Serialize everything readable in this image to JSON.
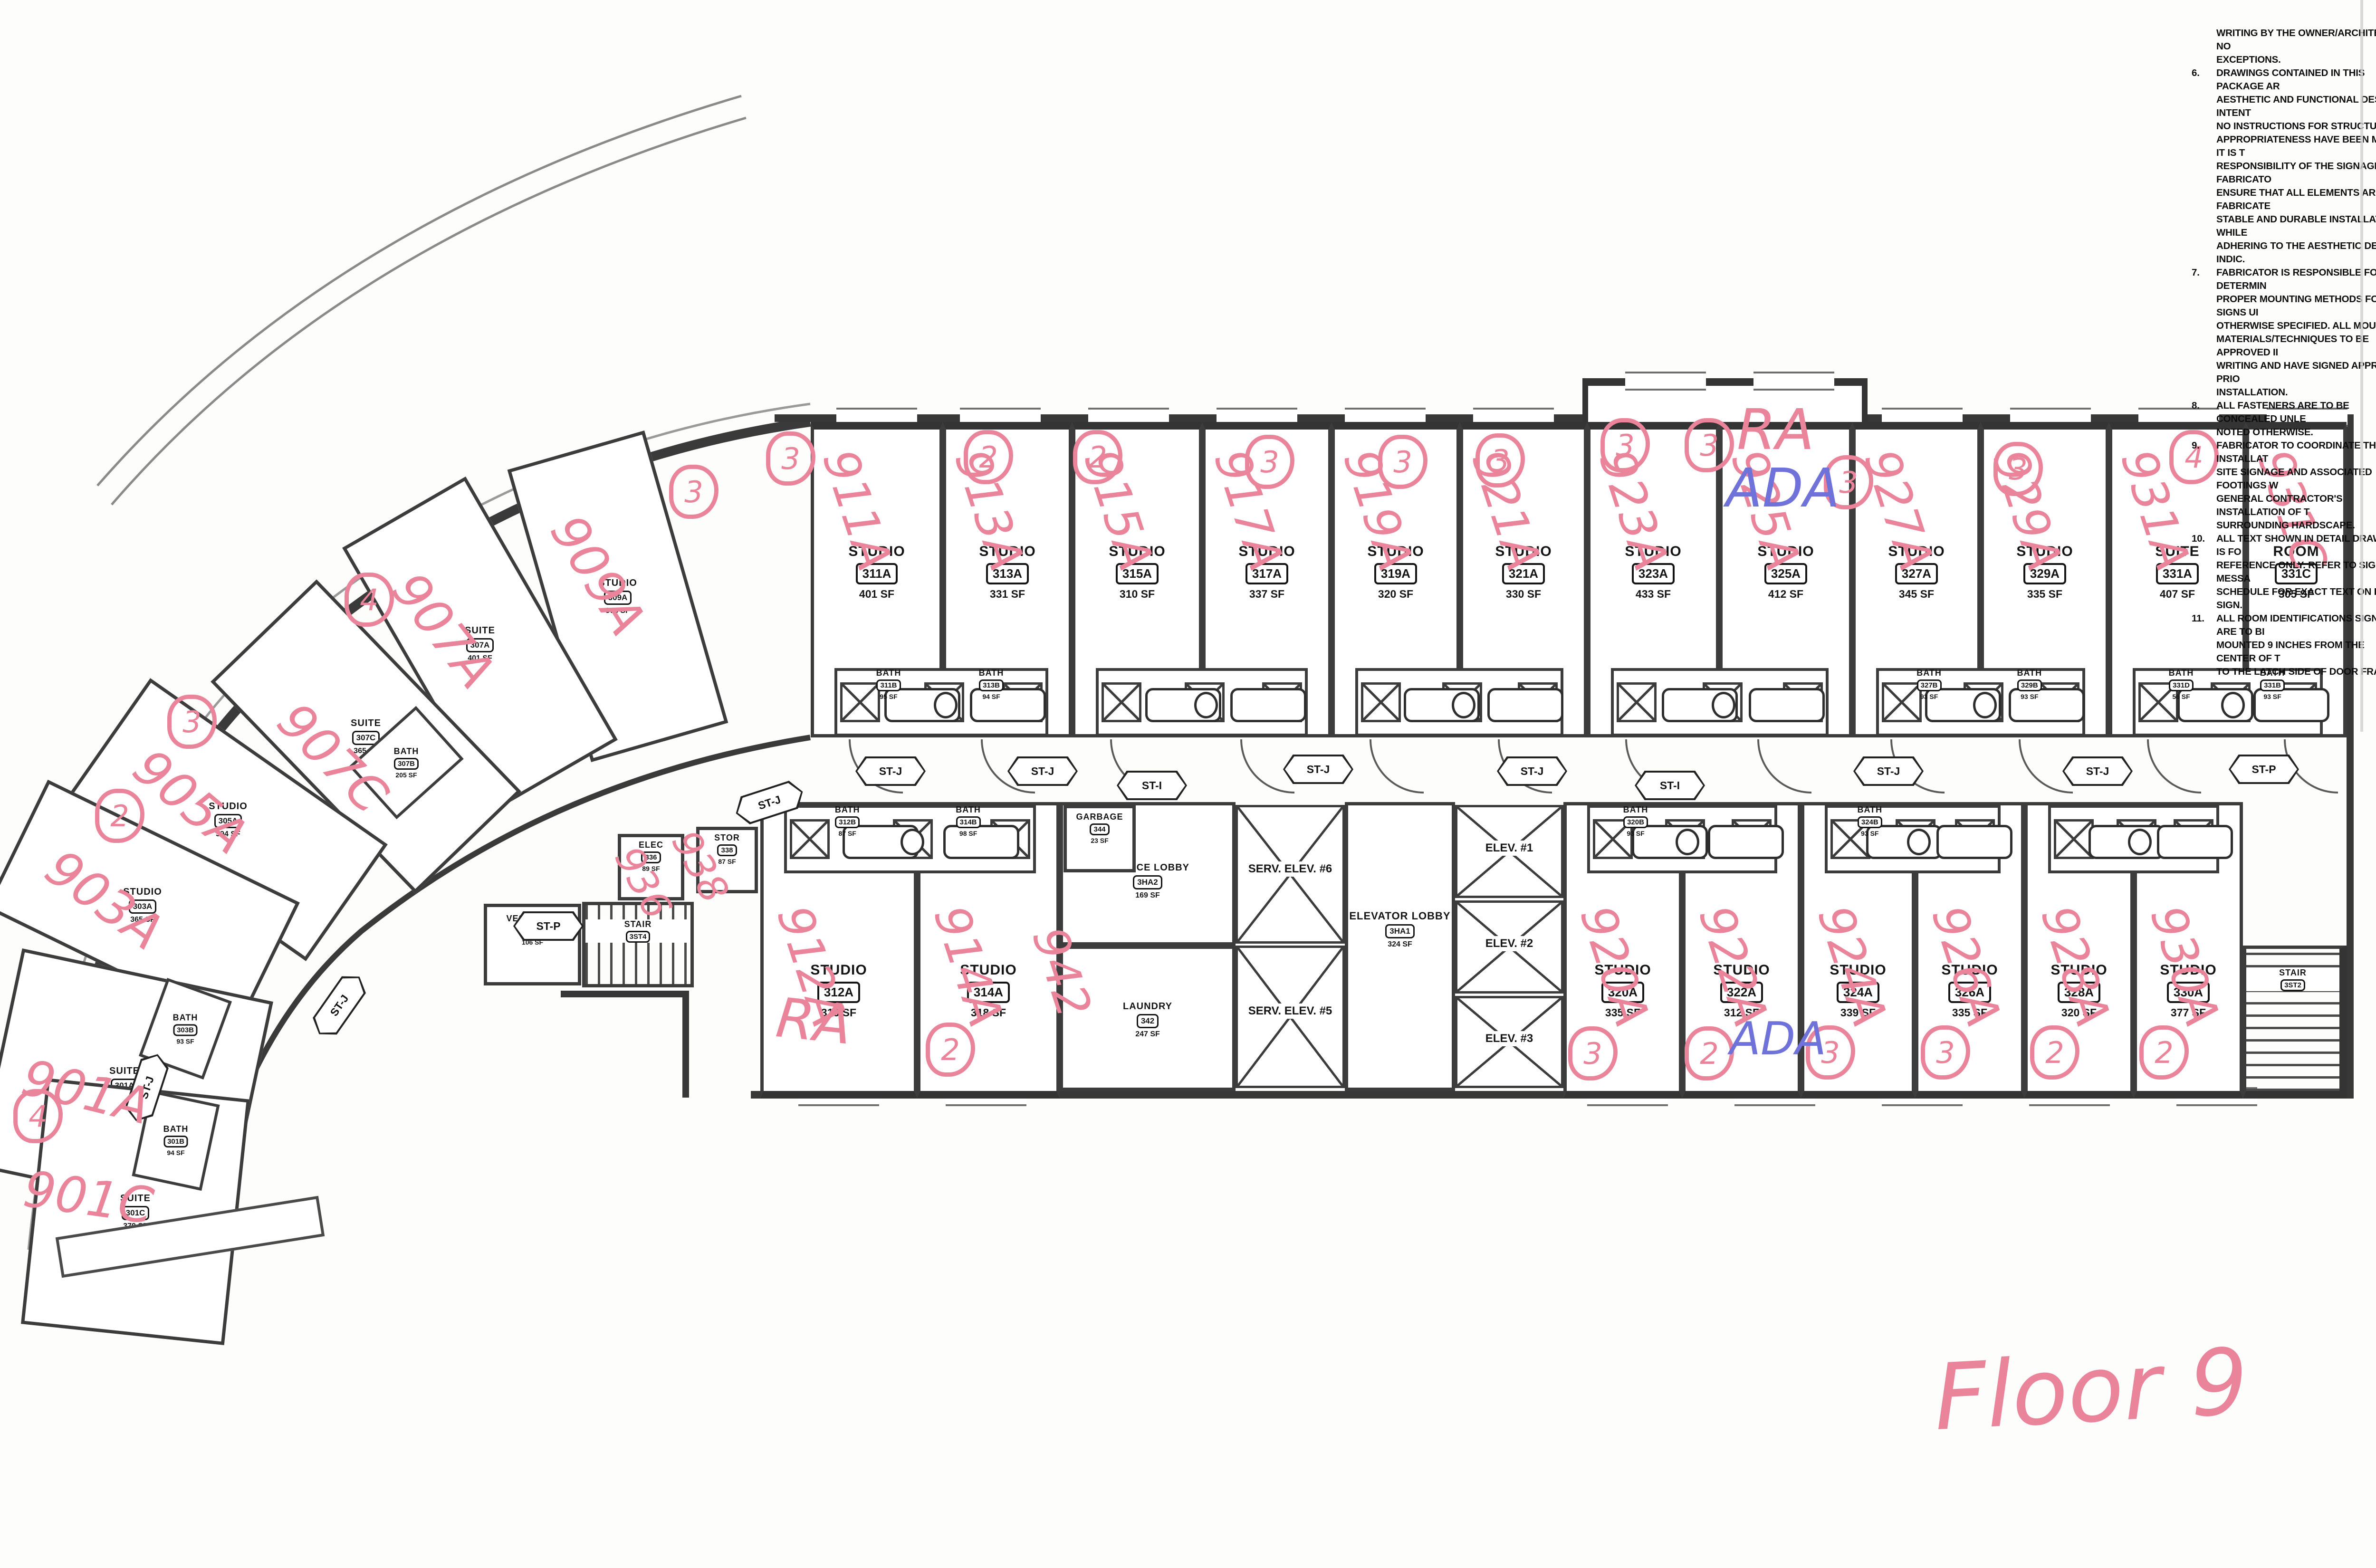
{
  "floor_label": "Floor 9",
  "ink_colors": {
    "pink": "#e9849a",
    "blue": "#6f72d9",
    "print": "#141414"
  },
  "labels": {
    "studio": "STUDIO",
    "suite": "SUITE",
    "room": "ROOM",
    "bath": "BATH",
    "stair": "STAIR",
    "elec": "ELEC",
    "stor": "STOR",
    "vestibule": "VESTIBULE",
    "garbage": "GARBAGE",
    "laundry": "LAUNDRY",
    "service_lobby": "SERVICE LOBBY",
    "elevator_lobby": "ELEVATOR LOBBY"
  },
  "rooms": {
    "911A": {
      "type": "studio",
      "tag": "311A",
      "sf": "401 SF",
      "hand": "911A",
      "circle": "3"
    },
    "913A": {
      "type": "studio",
      "tag": "313A",
      "sf": "331 SF",
      "hand": "913A",
      "circle": "2"
    },
    "915A": {
      "type": "studio",
      "tag": "315A",
      "sf": "310 SF",
      "hand": "915A",
      "circle": "2"
    },
    "917A": {
      "type": "studio",
      "tag": "317A",
      "sf": "337 SF",
      "hand": "917A",
      "circle": "3"
    },
    "919A": {
      "type": "studio",
      "tag": "319A",
      "sf": "320 SF",
      "hand": "919A",
      "circle": "3"
    },
    "921A": {
      "type": "studio",
      "tag": "321A",
      "sf": "330 SF",
      "hand": "921A",
      "circle": "3"
    },
    "923A": {
      "type": "studio",
      "tag": "323A",
      "sf": "433 SF",
      "hand": "923A",
      "circle": "3"
    },
    "925A": {
      "type": "studio",
      "tag": "325A",
      "sf": "412 SF",
      "hand": "925A",
      "circle": "3"
    },
    "927A": {
      "type": "studio",
      "tag": "327A",
      "sf": "345 SF",
      "hand": "927A",
      "circle": "3"
    },
    "929A": {
      "type": "studio",
      "tag": "329A",
      "sf": "335 SF",
      "hand": "929A",
      "circle": "3"
    },
    "931A": {
      "type": "suite",
      "tag": "331A",
      "sf": "407 SF",
      "hand": "931A",
      "circle": "4"
    },
    "931C": {
      "type": "room",
      "tag": "331C",
      "sf": "305 SF",
      "hand": "931C",
      "circle": ""
    },
    "912A": {
      "type": "studio",
      "tag": "312A",
      "sf": "315 SF",
      "hand": "912A",
      "circle": ""
    },
    "914A": {
      "type": "studio",
      "tag": "314A",
      "sf": "318 SF",
      "hand": "914A",
      "circle": "2"
    },
    "920A": {
      "type": "studio",
      "tag": "320A",
      "sf": "335 SF",
      "hand": "920A",
      "circle": "3"
    },
    "922A": {
      "type": "studio",
      "tag": "322A",
      "sf": "312 SF",
      "hand": "922A",
      "circle": "2"
    },
    "924A": {
      "type": "studio",
      "tag": "324A",
      "sf": "339 SF",
      "hand": "924A",
      "circle": "3"
    },
    "926A": {
      "type": "studio",
      "tag": "326A",
      "sf": "335 SF",
      "hand": "926A",
      "circle": "3"
    },
    "928A": {
      "type": "studio",
      "tag": "328A",
      "sf": "320 SF",
      "hand": "928A",
      "circle": "2"
    },
    "930A": {
      "type": "studio",
      "tag": "330A",
      "sf": "377 SF",
      "hand": "930A",
      "circle": "2"
    },
    "909A": {
      "type": "studio",
      "tag": "309A",
      "sf": "378 SF",
      "hand": "909A",
      "circle": "3"
    },
    "907A": {
      "type": "suite",
      "tag": "307A",
      "sf": "401 SF",
      "hand": "907A",
      "circle": ""
    },
    "907C": {
      "type": "suite",
      "tag": "307C",
      "sf": "365 SF",
      "hand": "907C",
      "circle": "4"
    },
    "905A": {
      "type": "studio",
      "tag": "305A",
      "sf": "394 SF",
      "hand": "905A",
      "circle": "3"
    },
    "903A": {
      "type": "studio",
      "tag": "303A",
      "sf": "365 SF",
      "hand": "903A",
      "circle": "2"
    },
    "901A": {
      "type": "suite",
      "tag": "301A",
      "sf": "460 SF",
      "hand": "901A",
      "circle": "4"
    },
    "901C": {
      "type": "suite",
      "tag": "301C",
      "sf": "379 SF",
      "hand": "901C",
      "circle": ""
    }
  },
  "baths": {
    "311B": "95 SF",
    "313B": "94 SF",
    "327B": "93 SF",
    "329B": "93 SF",
    "331D": "56 SF",
    "331B": "93 SF",
    "312B": "87 SF",
    "314B": "98 SF",
    "320B": "93 SF",
    "324B": "93 SF",
    "307B": "205 SF",
    "303B": "93 SF",
    "301B": "94 SF"
  },
  "core": {
    "service_lobby": {
      "tag": "3HA2",
      "sf": "169 SF"
    },
    "elevator_lobby": {
      "tag": "3HA1",
      "sf": "324 SF"
    },
    "laundry": {
      "tag": "342",
      "sf": "247 SF"
    },
    "garbage": {
      "tag": "344",
      "sf": "23 SF"
    },
    "elec": {
      "tag": "336",
      "sf": "89 SF"
    },
    "stor": {
      "tag": "338",
      "sf": "87 SF"
    },
    "vestibule": {
      "tag": "332",
      "sf": "106 SF"
    },
    "stair4": {
      "tag": "3ST4"
    },
    "stair2": {
      "tag": "3ST2"
    },
    "elev6": "SERV. ELEV. #6",
    "elev5": "SERV. ELEV. #5",
    "elev1": "ELEV. #1",
    "elev2": "ELEV. #2",
    "elev3": "ELEV. #3"
  },
  "corridor_tags": {
    "J": "ST-J",
    "I": "ST-I",
    "P": "ST-P"
  },
  "annotations": {
    "ra_912": "RA",
    "ra_925": "RA",
    "ada_925": "ADA",
    "ada_922": "ADA",
    "n936": "936",
    "n938": "938",
    "n942": "942"
  },
  "notes": {
    "preamble": [
      "WRITING BY THE OWNER/ARCHITECT.  NO",
      "EXCEPTIONS."
    ],
    "items": [
      {
        "n": "6.",
        "lines": [
          "DRAWINGS CONTAINED IN THIS PACKAGE AR",
          "AESTHETIC AND FUNCTIONAL DESIGN INTENT",
          "NO INSTRUCTIONS FOR STRUCTURAL",
          "APPROPRIATENESS HAVE BEEN MADE.  IT IS T",
          "RESPONSIBILITY OF THE SIGNAGE FABRICATO",
          "ENSURE THAT ALL ELEMENTS ARE FABRICATE",
          "STABLE AND DURABLE INSTALLATION WHILE",
          "ADHERING TO THE AESTHETIC DETAILS INDIC."
        ]
      },
      {
        "n": "7.",
        "lines": [
          "FABRICATOR IS RESPONSIBLE FOR DETERMIN",
          "PROPER MOUNTING METHODS FOR SIGNS UI",
          "OTHERWISE SPECIFIED.  ALL MOUNTING",
          "MATERIALS/TECHNIQUES TO BE APPROVED II",
          "WRITING AND HAVE SIGNED APPROVAL PRIO",
          "INSTALLATION."
        ]
      },
      {
        "n": "8.",
        "lines": [
          "ALL FASTENERS ARE TO BE CONCEALED UNLE",
          "NOTED OTHERWISE."
        ]
      },
      {
        "n": "9.",
        "lines": [
          "FABRICATOR TO COORDINATE THE INSTALLAT",
          "SITE SIGNAGE AND ASSOCIATED FOOTINGS W",
          "GENERAL CONTRACTOR'S INSTALLATION OF T",
          "SURROUNDING HARDSCAPE."
        ]
      },
      {
        "n": "10.",
        "lines": [
          "ALL TEXT SHOWN IN DETAIL DRAWINGS IS FO",
          "REFERENCE ONLY.  REFER TO SIGNAGE MESSA",
          "SCHEDULE FOR EXACT TEXT ON EACH SIGN."
        ]
      },
      {
        "n": "11.",
        "lines": [
          "ALL ROOM IDENTIFICATIONS SIGNS ARE TO BI",
          "MOUNTED 9 INCHES FROM THE CENTER OF T",
          "TO THE LATCH SIDE OF DOOR FRAME."
        ]
      }
    ]
  }
}
